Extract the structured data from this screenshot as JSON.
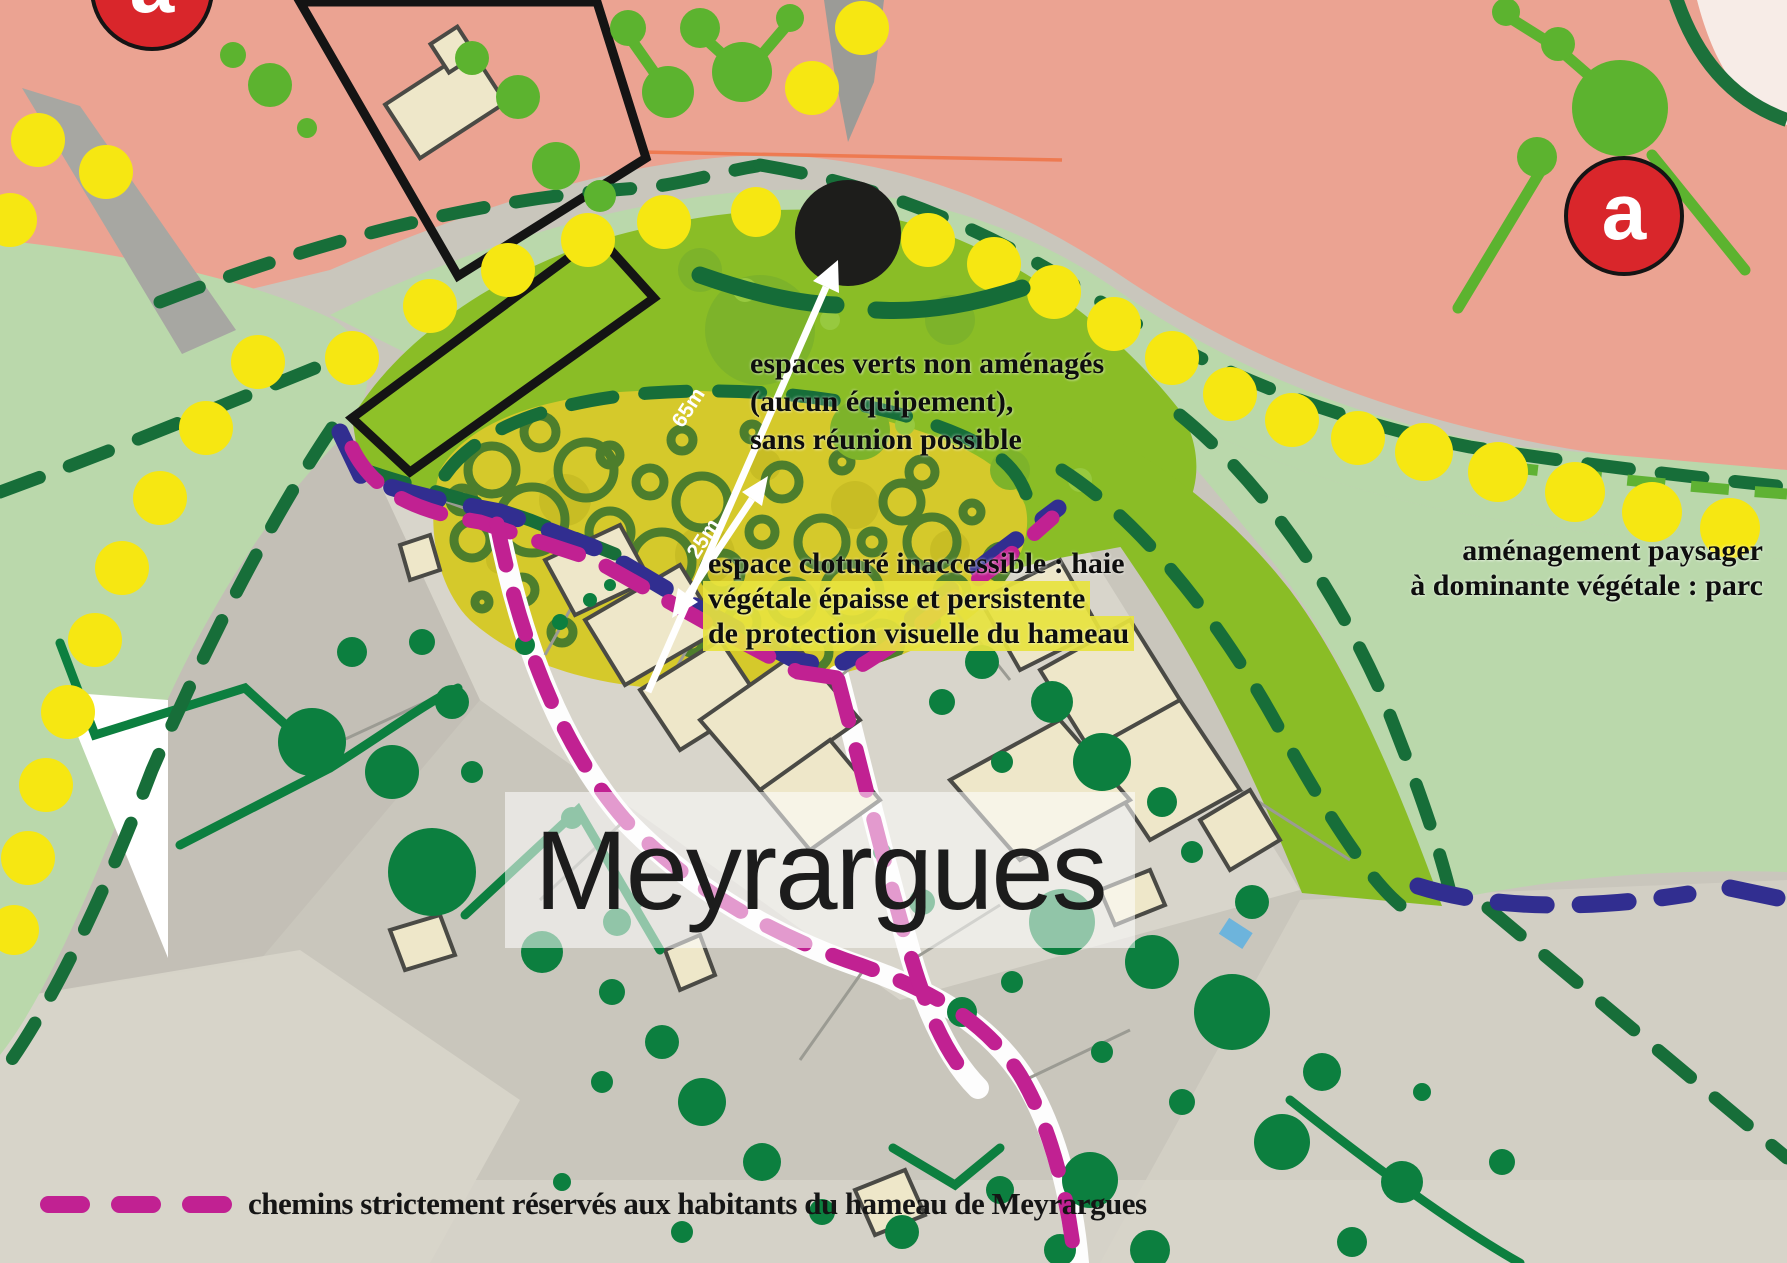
{
  "map": {
    "place_label": "Meyrargues",
    "zone_markers": {
      "left": "a",
      "right": "a"
    },
    "measurements": {
      "long": "65m",
      "short": "25m"
    },
    "annotations": {
      "espaces_verts": {
        "line1": "espaces verts non aménagés",
        "line2": "(aucun équipement),",
        "line3": "sans réunion possible"
      },
      "espace_cloture": {
        "line1": "espace cloturé inaccessible : haie",
        "line2": "végétale épaisse et persistente",
        "line3": "de protection visuelle du hameau"
      },
      "amenagement": {
        "line1": "aménagement paysager",
        "line2": "à dominante végétale : parc"
      }
    },
    "legend": {
      "label": "chemins strictement réservés aux habitants du hameau de Meyrargues"
    },
    "colors": {
      "salmon": "#eba392",
      "pale_green": "#bad8ab",
      "bright_green": "#8abd26",
      "olive_zone": "#d5c92b",
      "ring_green": "#4d7e2c",
      "dark_green": "#176e39",
      "tree_green": "#0c7f3f",
      "dot_yellow": "#f6e712",
      "path_magenta": "#c12192",
      "boundary_navy": "#312e90",
      "marker_red": "#d9262b",
      "building_beige": "#eee7c9",
      "photo_gray": "#c9c6bc",
      "disc_black": "#1d1d1b"
    }
  }
}
